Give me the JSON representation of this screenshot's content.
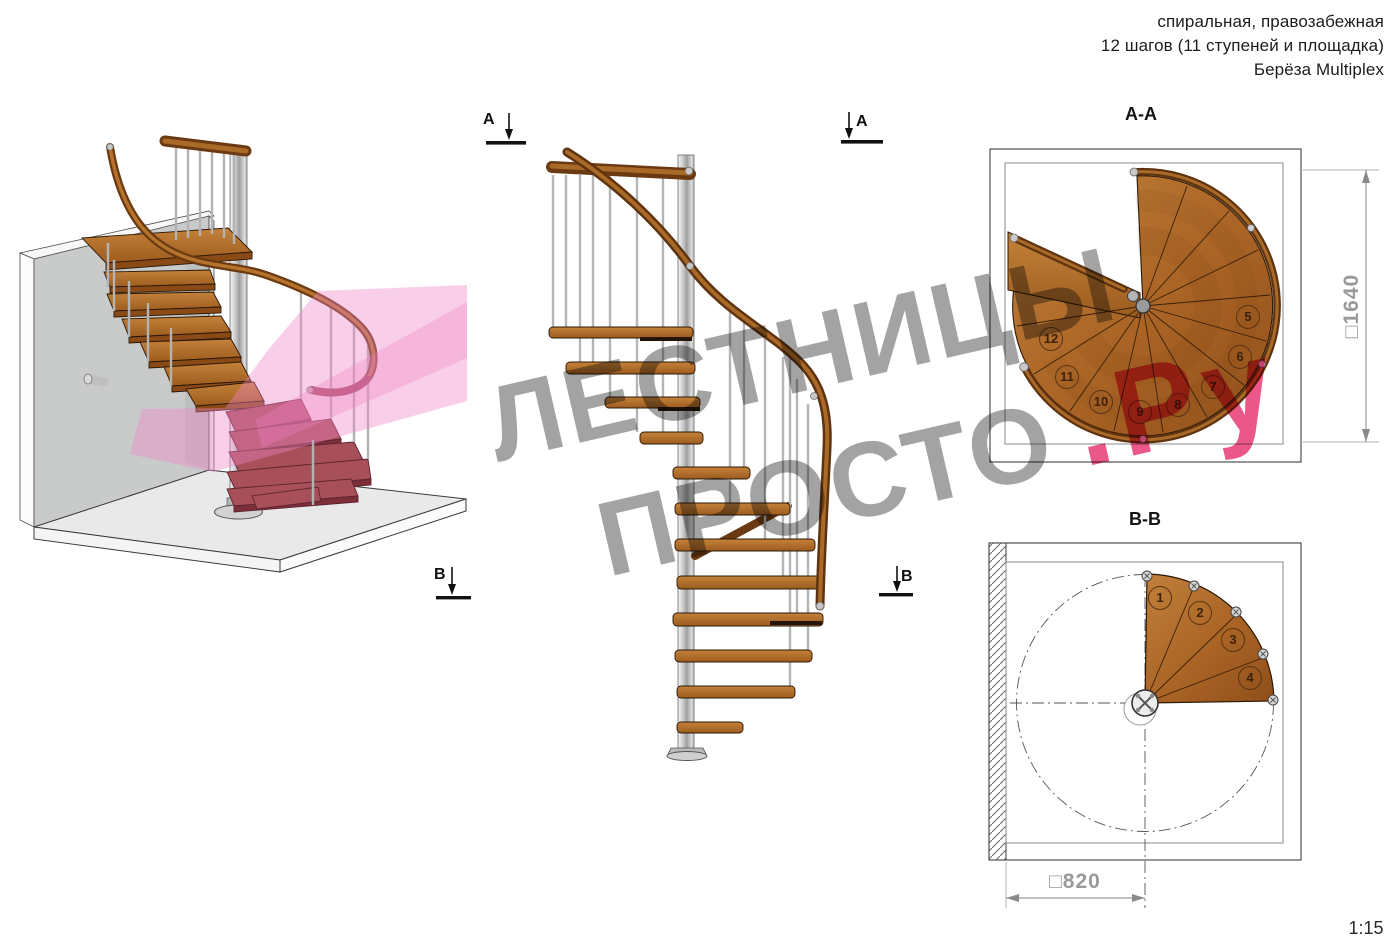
{
  "header": {
    "line1": "спиральная, правозабежная",
    "line2": "12 шагов (11 ступеней и площадка)",
    "line3": "Берёза Multiplex"
  },
  "watermark": {
    "word1": "ЛЕСТНИЦЫ",
    "word2": "ПРОСТО",
    "suffix": ".Ру"
  },
  "views": {
    "perspective": {
      "marker_b": "B"
    },
    "elevation": {
      "marker_a_left": "A",
      "marker_a_right": "A",
      "marker_b_right": "B"
    },
    "plan_aa": {
      "title": "A-A",
      "dimension": "□1640",
      "steps": [
        "5",
        "6",
        "7",
        "8",
        "9",
        "10",
        "11",
        "12"
      ]
    },
    "plan_bb": {
      "title": "B-B",
      "dimension": "□820",
      "steps": [
        "1",
        "2",
        "3",
        "4"
      ]
    }
  },
  "scale_label": "1:15",
  "colors": {
    "wood": "#b5722c",
    "wood_dark": "#6b3a12",
    "metal": "#c4c4c4",
    "wall": "#c9caca",
    "section_plane_pink": "#ef84c5",
    "watermark_gray": "#8f8f8f",
    "watermark_pink": "#e6316e",
    "lower_steps_red": "#a8505a"
  }
}
